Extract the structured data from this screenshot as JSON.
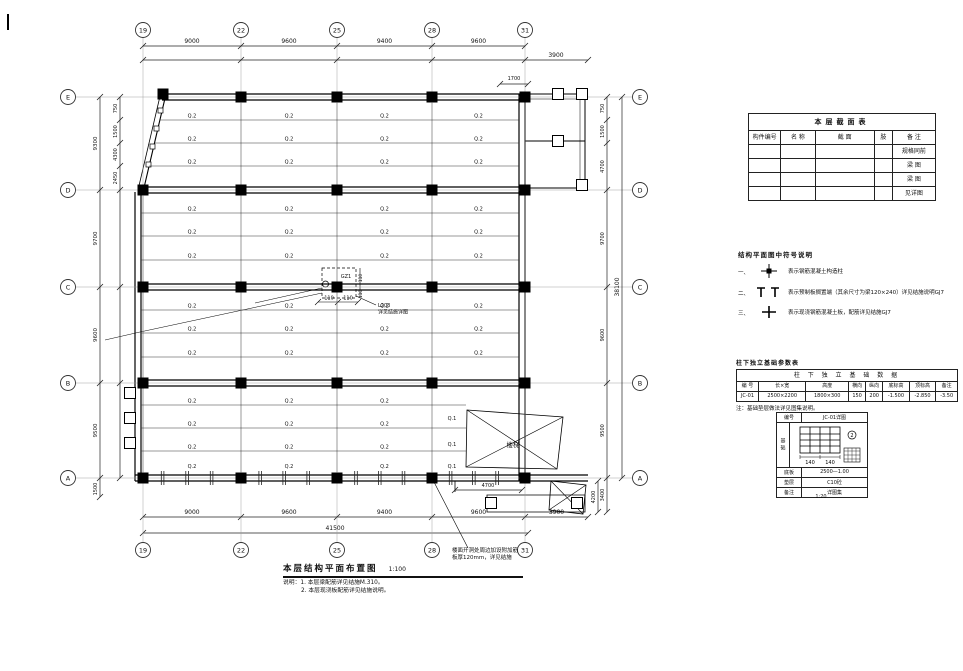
{
  "drawing": {
    "title": "本层结构平面布置图",
    "scale": "1:100",
    "note1": "说明：1. 本层梁配筋详见结施M.310。",
    "note2": "2. 本层现浇板配筋详见结施说明。",
    "leader_note1": "楼面开洞处周边加设附加筋",
    "leader_note2": "板厚120mm，详见结施",
    "grid_cols": [
      "19",
      "22",
      "25",
      "28",
      "31"
    ],
    "grid_rows": [
      "E",
      "D",
      "C",
      "B",
      "A"
    ],
    "joist_label": "Q.2",
    "joist_label_alt": "Q.1",
    "stair_label": "楼梯",
    "dims": {
      "top": [
        "9000",
        "9600",
        "9400",
        "9600"
      ],
      "top_ext": "3900",
      "porch_top": "1700",
      "bottom": [
        "9000",
        "9600",
        "9400",
        "9600",
        "3900"
      ],
      "bottom_total": "41500",
      "left_outer": [
        "9300",
        "9700",
        "9600",
        "9500"
      ],
      "left_below": "1500",
      "left_inner": [
        "750",
        "1500",
        "4300",
        "2450"
      ],
      "right_segs": [
        "750",
        "1500",
        "4700",
        "9700",
        "9600",
        "9500",
        "3400"
      ],
      "right_total": "38100",
      "porch_w": "4700",
      "porch_h": "4200"
    },
    "detail_callout": {
      "tag": "GZ1",
      "dim1": "110",
      "dim2": "110",
      "vdim1": "110",
      "vdim2": "110",
      "text1": "L203",
      "text2": "详见结施详图"
    }
  },
  "section_table": {
    "title": "本层截面表",
    "headers": [
      "构件编号",
      "名 称",
      "截 面",
      "肢",
      "备 注"
    ],
    "rows": [
      [
        "",
        "",
        "",
        "",
        "规格同前"
      ],
      [
        "",
        "",
        "",
        "",
        "梁 图"
      ],
      [
        "",
        "",
        "",
        "",
        "梁 图"
      ],
      [
        "",
        "",
        "",
        "",
        "见详图"
      ]
    ]
  },
  "symbol_notes": {
    "title": "结构平面图中符号说明",
    "items": [
      {
        "no": "一、",
        "text": "表示钢筋混凝土构造柱"
      },
      {
        "no": "二、",
        "text": "表示预制板搁置端（其余尺寸为梁120×240）详见结施说明GJ7"
      },
      {
        "no": "三、",
        "text": "表示现浇钢筋混凝土板，配筋详见结施GJ7"
      }
    ]
  },
  "foundation_table": {
    "caption": "柱下独立基础参数表",
    "span_header": "柱 下 独 立 基 础 数 据",
    "headers": [
      "编 号",
      "长×宽",
      "高度",
      "横向",
      "纵向",
      "底标高",
      "顶标高",
      "备注"
    ],
    "row": [
      "JC-01",
      "2500×2200",
      "1800×300",
      "150",
      "200",
      "-1.500",
      "-2.850",
      "-3.50"
    ],
    "note": "注：基础垫层做法详见图集说明。"
  },
  "foundation_detail": {
    "header_label": "编号",
    "header_value": "JC-01详图",
    "side_label": "基础",
    "dim1": "140",
    "dim2": "140",
    "marker": "2",
    "rows": [
      [
        "底板",
        "2500—1.00"
      ],
      [
        "垫层",
        "C10砼"
      ],
      [
        "备注",
        "详图集"
      ]
    ],
    "caption": "1:20"
  }
}
